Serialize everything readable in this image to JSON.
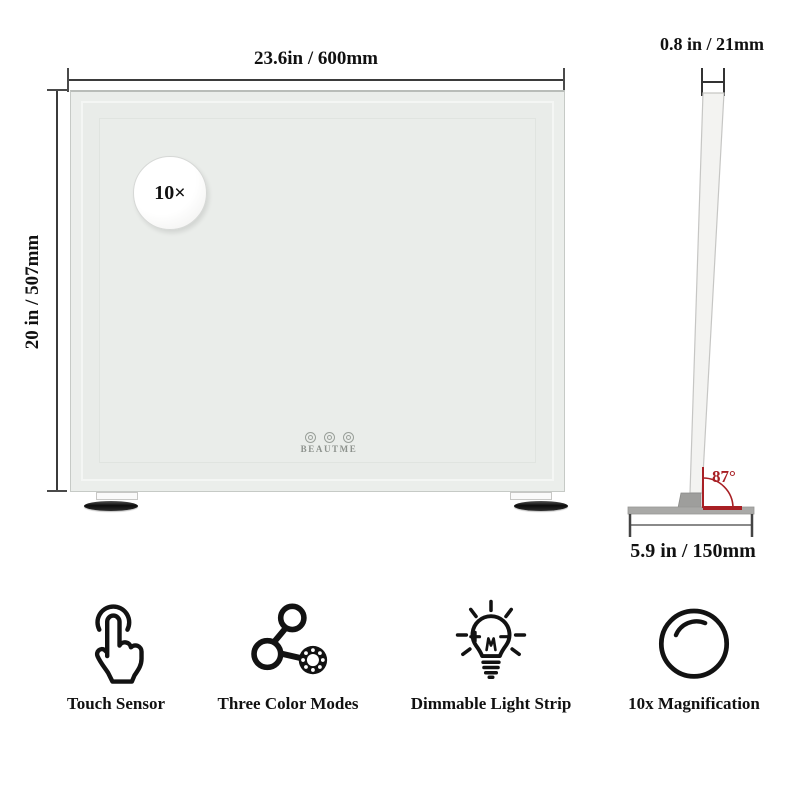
{
  "front_view": {
    "width_dimension": "23.6in / 600mm",
    "height_dimension": "20 in / 507mm",
    "magnification_badge": "10×",
    "brand": "BEAUTME"
  },
  "side_view": {
    "thickness_dimension": "0.8 in / 21mm",
    "tilt_angle": "87°",
    "base_dimension": "5.9 in / 150mm"
  },
  "features": [
    {
      "label": "Touch Sensor",
      "icon": "touch-sensor-icon"
    },
    {
      "label": "Three Color Modes",
      "icon": "three-color-modes-icon"
    },
    {
      "label": "Dimmable Light Strip",
      "icon": "dimmable-light-strip-icon"
    },
    {
      "label": "10x Magnification",
      "icon": "magnification-icon"
    }
  ],
  "icons": {
    "mirror_buttons": [
      "touch-control-icon",
      "touch-control-icon",
      "touch-control-icon"
    ]
  },
  "colors": {
    "angle_accent": "#a81f24",
    "dimension_line": "#3b3b3b",
    "mirror_surface": "#ebeeeb"
  }
}
